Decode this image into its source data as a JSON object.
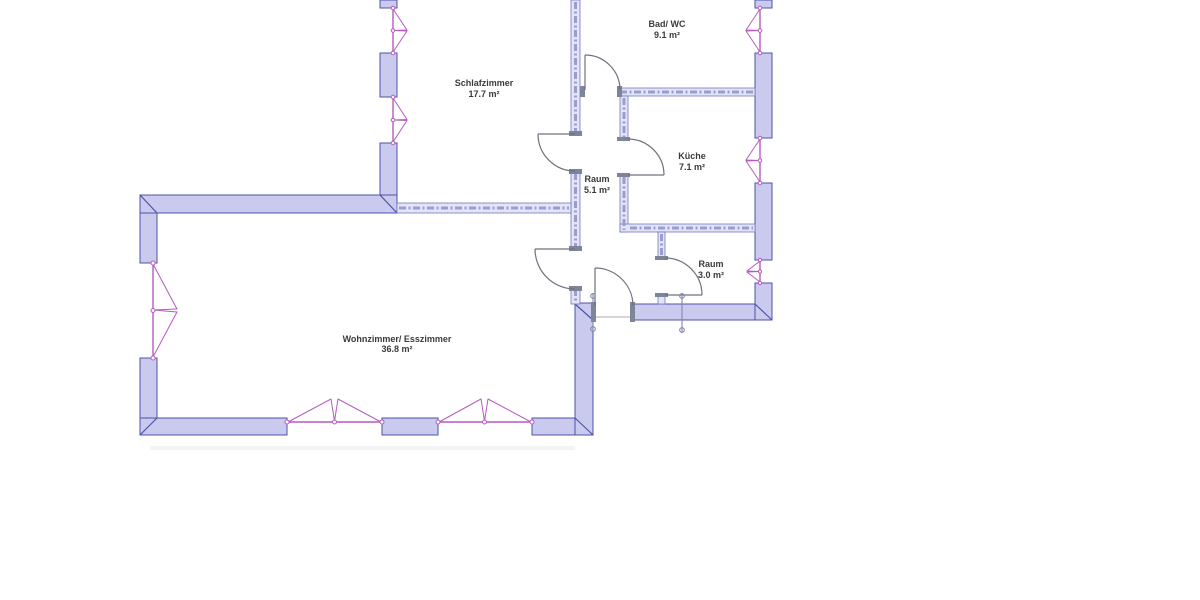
{
  "plan": {
    "background": "#ffffff",
    "colors": {
      "background": "#ffffff",
      "wall_fill": "#c9caee",
      "wall_stroke": "#4f53a8",
      "thin_fill": "#e3e4f8",
      "thin_stroke": "#7478bd",
      "hatch": "#9a9ecf",
      "door": "#70707e",
      "jamb": "#7d8598",
      "window": "#b65ac1",
      "marker": "#8087a8",
      "label": "#3b3b3b"
    },
    "rooms": [
      {
        "id": "schlafzimmer",
        "name": "Schlafzimmer",
        "area": "17.7 m²"
      },
      {
        "id": "bad-wc",
        "name": "Bad/ WC",
        "area": "9.1 m²"
      },
      {
        "id": "kueche",
        "name": "Küche",
        "area": "7.1 m²"
      },
      {
        "id": "raum-5-1",
        "name": "Raum",
        "area": "5.1 m²"
      },
      {
        "id": "raum-3-0",
        "name": "Raum",
        "area": "3.0 m²"
      },
      {
        "id": "wohnzimmer",
        "name": "Wohnzimmer/ Esszimmer",
        "area": "36.8 m²"
      }
    ]
  }
}
